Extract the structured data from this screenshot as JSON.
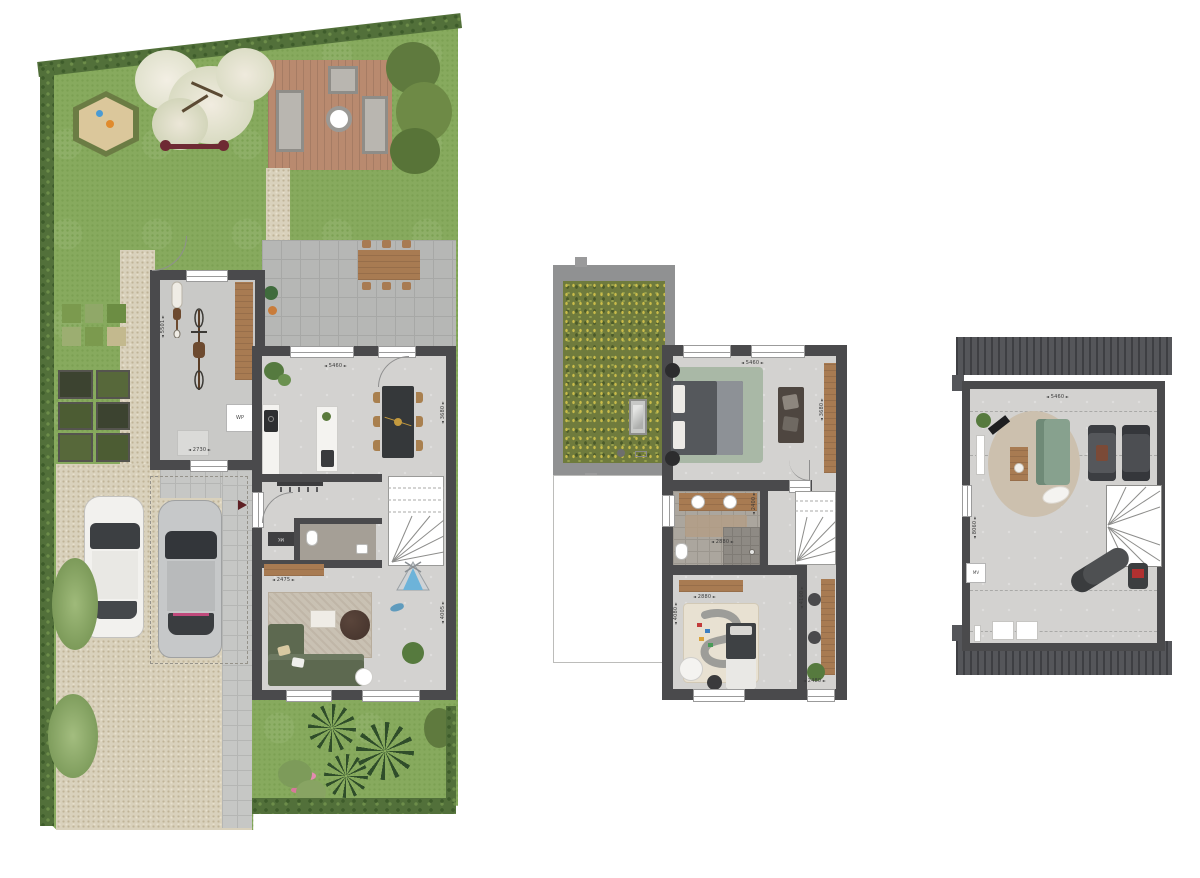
{
  "ground_floor": {
    "labels": {
      "heat_pump": "WP",
      "meter_closet": "MK"
    },
    "dims": {
      "garage_depth": "5501",
      "garage_width": "2730",
      "living_width": "5460",
      "dining_depth": "3680",
      "hall_width": "2475",
      "living_depth": "4005"
    }
  },
  "first_floor": {
    "dims": {
      "bedroom_width": "5460",
      "bedroom_depth": "3680",
      "bathroom_depth": "2400",
      "bathroom_width": "2880",
      "kids_room_width": "2880",
      "kids_room_depth": "4080",
      "study_depth": "4100",
      "study_width": "2480"
    }
  },
  "attic": {
    "labels": {
      "mech_vent": "MV"
    },
    "dims": {
      "width": "5460",
      "depth": "8060"
    }
  },
  "colors": {
    "wall": "#4a4a4c",
    "floor": "#d3d2d0",
    "grass": "#87aa5e",
    "hedge": "#52703a",
    "deck_wood": "#b98a6f",
    "gravel": "#d9d1bc",
    "green_roof": "#6f7b3d",
    "roof": "#55565a",
    "sofa_green": "#5d6950",
    "entry_arrow": "#5e2024"
  }
}
